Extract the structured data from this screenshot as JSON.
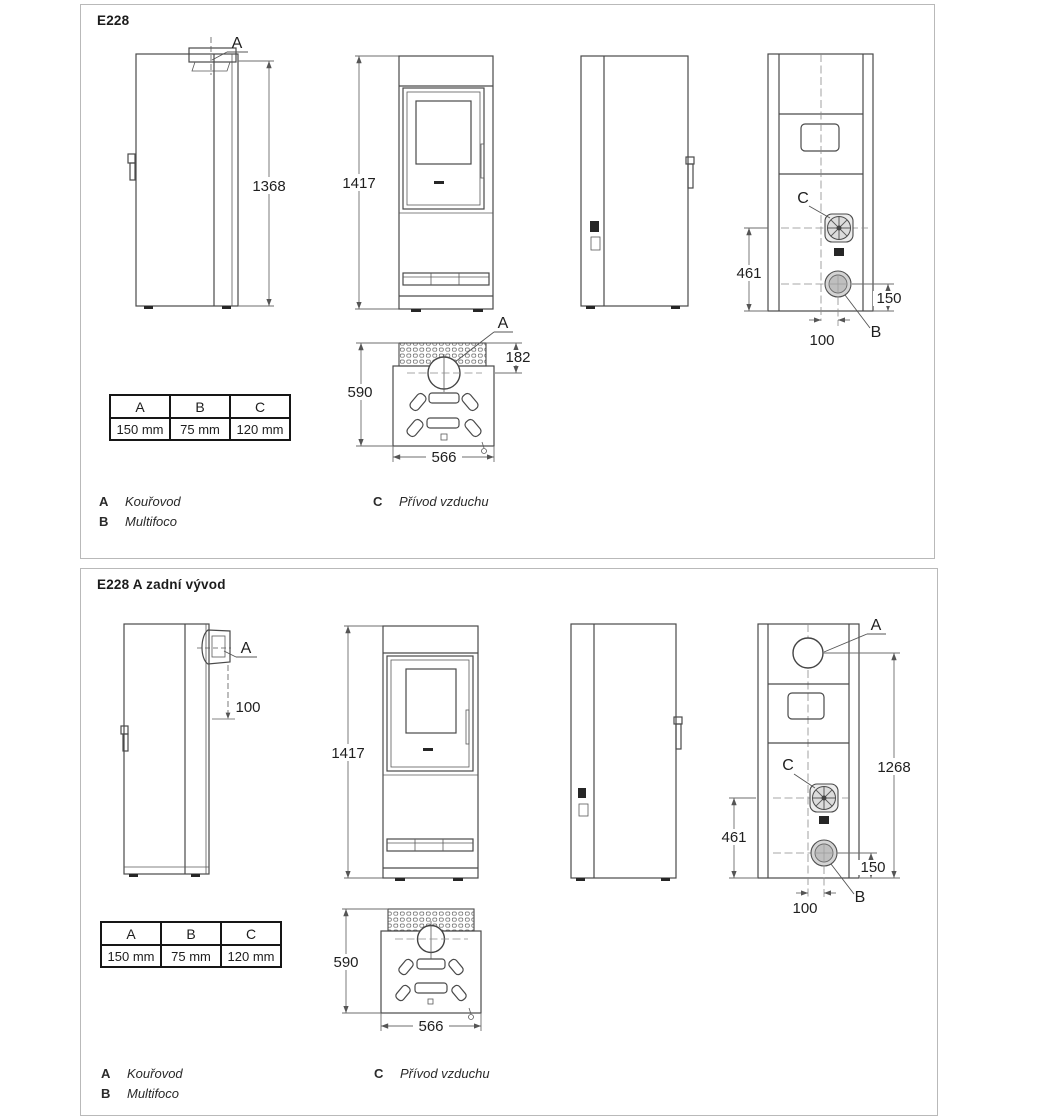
{
  "page": {
    "background": "#ffffff",
    "line_color": "#4a4a4a",
    "panel_border": "#b9b9b9"
  },
  "panels": [
    {
      "title": "E228",
      "views": {
        "side": {
          "label_a": "A",
          "dim_height": "1368"
        },
        "front": {
          "dim_height": "1417"
        },
        "rear": {
          "label_c": "C",
          "label_b": "B",
          "dim_c_height": "461",
          "dim_b_height": "150",
          "dim_offset": "100"
        },
        "top": {
          "label_a": "A",
          "dim_flue": "182",
          "dim_depth": "590",
          "dim_width": "566"
        }
      },
      "table": {
        "headers": [
          "A",
          "B",
          "C"
        ],
        "values": [
          "150 mm",
          "75 mm",
          "120 mm"
        ]
      },
      "legend": {
        "a_key": "A",
        "a_label": "Kouřovod",
        "b_key": "B",
        "b_label": "Multifoco",
        "c_key": "C",
        "c_label": "Přívod vzduchu"
      }
    },
    {
      "title": "E228 A zadní vývod",
      "views": {
        "side": {
          "label_a": "A",
          "dim_outlet": "100"
        },
        "front": {
          "dim_height": "1417"
        },
        "rear": {
          "label_a": "A",
          "label_c": "C",
          "label_b": "B",
          "dim_a_height": "1268",
          "dim_c_height": "461",
          "dim_b_height": "150",
          "dim_offset": "100"
        },
        "top": {
          "dim_depth": "590",
          "dim_width": "566"
        }
      },
      "table": {
        "headers": [
          "A",
          "B",
          "C"
        ],
        "values": [
          "150 mm",
          "75 mm",
          "120 mm"
        ]
      },
      "legend": {
        "a_key": "A",
        "a_label": "Kouřovod",
        "b_key": "B",
        "b_label": "Multifoco",
        "c_key": "C",
        "c_label": "Přívod vzduchu"
      }
    }
  ]
}
